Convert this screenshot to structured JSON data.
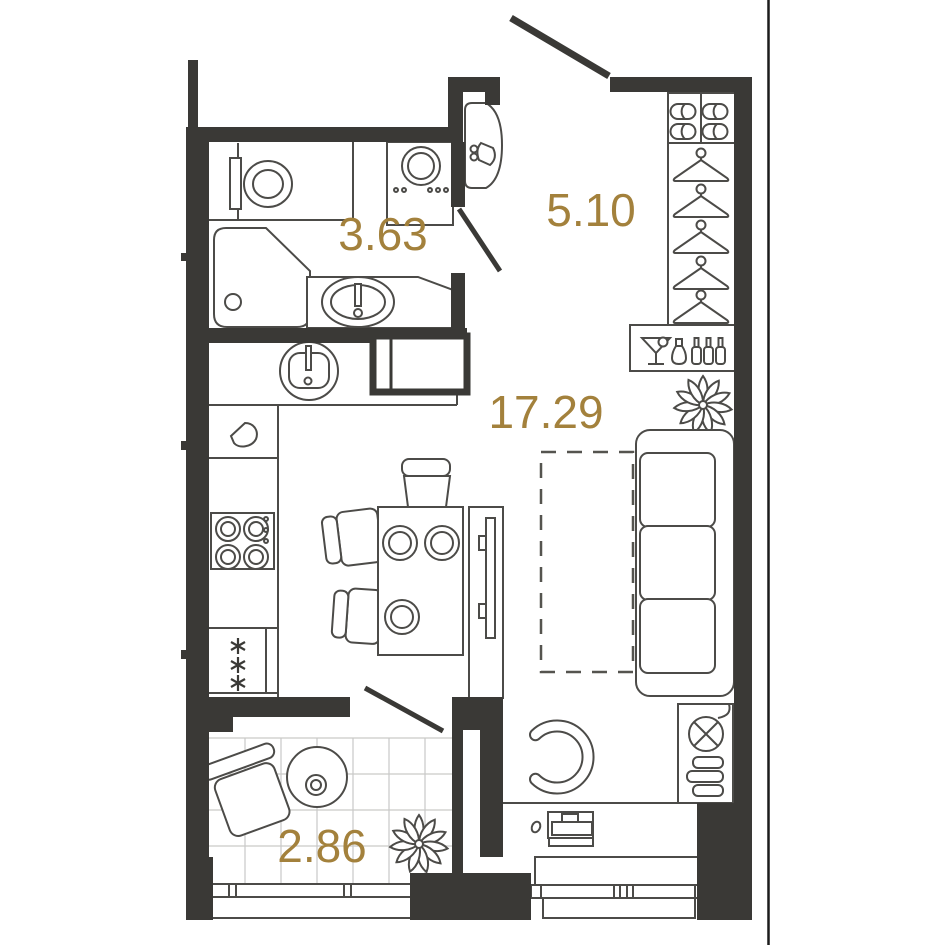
{
  "plan": {
    "title": "Studio apartment floor plan",
    "unit": "m2",
    "rooms": [
      {
        "id": "bathroom",
        "area": "3.63"
      },
      {
        "id": "hallway",
        "area": "5.10"
      },
      {
        "id": "living-kitchen",
        "area": "17.29"
      },
      {
        "id": "balcony",
        "area": "2.86"
      }
    ],
    "colors": {
      "wall": "#3a3936",
      "fixture_line": "#4c4b48",
      "area_label": "#a3813c",
      "tile_grid": "#c9c9c7",
      "background": "#ffffff"
    },
    "fixtures": [
      "toilet-icon",
      "shower-cabin-icon",
      "vanity-sink-icon",
      "washing-machine-icon",
      "water-heater-icon",
      "shoe-shelf-icon",
      "hanger-icon",
      "minibar-icon",
      "plant-icon",
      "kitchen-sink-icon",
      "kettle-icon",
      "cooktop-icon",
      "fridge-freezer-icon",
      "dining-table-icon",
      "chair-icon",
      "tv-stand-icon",
      "bed-space-dashed-icon",
      "sofa-icon",
      "radiator-icon",
      "armchair-icon",
      "laptop-icon",
      "balcony-chair-icon",
      "balcony-table-icon",
      "window-icon",
      "door-swing-icon"
    ]
  }
}
